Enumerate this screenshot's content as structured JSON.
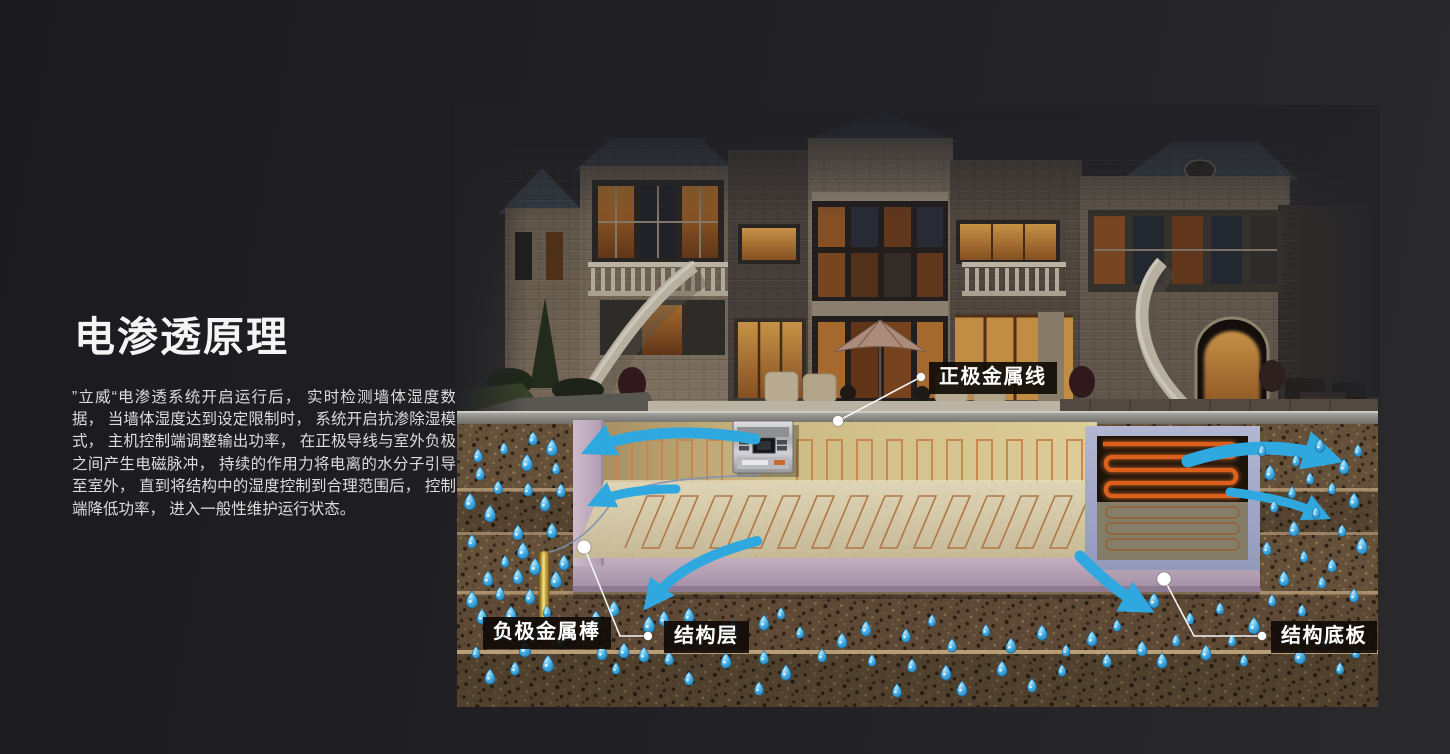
{
  "intro": {
    "title": "电渗透原理",
    "body": "”立威“电渗透系统开启运行后， 实时检测墙体湿度数据， 当墙体湿度达到设定限制时， 系统开启抗渗除湿模式， 主机控制端调整输出功率， 在正极导线与室外负极之间产生电磁脉冲， 持续的作用力将电离的水分子引导至室外， 直到将结构中的湿度控制到合理范围后， 控制端降低功率， 进入一般性维护运行状态。"
  },
  "diagram": {
    "labels": {
      "positive_wire": "正极金属线",
      "negative_rod": "负极金属棒",
      "structure_layer": "结构层",
      "base_plate": "结构底板"
    },
    "colors": {
      "arrow_blue": "#2fa8e0",
      "water_drop": "#4ab4e8",
      "copper_coil": "#c9854e",
      "structure_pink": "#c3b0c1",
      "right_frame_periwinkle": "#a8aecb",
      "soil_brown": "#65503a",
      "rod_gold": "#d8bc50",
      "label_background": "#14100a",
      "glow_coil_orange": "#dd5f1c"
    },
    "drops": [
      [
        533,
        438
      ],
      [
        552,
        447
      ],
      [
        504,
        448
      ],
      [
        478,
        455
      ],
      [
        527,
        462
      ],
      [
        556,
        468
      ],
      [
        480,
        473
      ],
      [
        498,
        487
      ],
      [
        528,
        489
      ],
      [
        561,
        490
      ],
      [
        470,
        501
      ],
      [
        545,
        503
      ],
      [
        490,
        513
      ],
      [
        518,
        532
      ],
      [
        552,
        530
      ],
      [
        472,
        541
      ],
      [
        523,
        550
      ],
      [
        505,
        561
      ],
      [
        535,
        566
      ],
      [
        564,
        562
      ],
      [
        488,
        578
      ],
      [
        518,
        576
      ],
      [
        556,
        579
      ],
      [
        500,
        593
      ],
      [
        472,
        599
      ],
      [
        530,
        596
      ],
      [
        547,
        611
      ],
      [
        511,
        614
      ],
      [
        482,
        616
      ],
      [
        540,
        630
      ],
      [
        500,
        634
      ],
      [
        525,
        648
      ],
      [
        560,
        640
      ],
      [
        476,
        652
      ],
      [
        548,
        663
      ],
      [
        515,
        668
      ],
      [
        490,
        676
      ],
      [
        596,
        618
      ],
      [
        614,
        608
      ],
      [
        649,
        624
      ],
      [
        664,
        618
      ],
      [
        689,
        615
      ],
      [
        764,
        622
      ],
      [
        781,
        613
      ],
      [
        602,
        652
      ],
      [
        624,
        650
      ],
      [
        644,
        654
      ],
      [
        669,
        658
      ],
      [
        689,
        678
      ],
      [
        726,
        660
      ],
      [
        764,
        657
      ],
      [
        786,
        672
      ],
      [
        616,
        668
      ],
      [
        842,
        640
      ],
      [
        866,
        628
      ],
      [
        906,
        635
      ],
      [
        932,
        620
      ],
      [
        952,
        645
      ],
      [
        986,
        630
      ],
      [
        1011,
        645
      ],
      [
        1042,
        632
      ],
      [
        1066,
        650
      ],
      [
        1092,
        638
      ],
      [
        1117,
        625
      ],
      [
        1142,
        648
      ],
      [
        872,
        660
      ],
      [
        912,
        665
      ],
      [
        946,
        672
      ],
      [
        1002,
        668
      ],
      [
        1062,
        670
      ],
      [
        1107,
        660
      ],
      [
        822,
        655
      ],
      [
        897,
        690
      ],
      [
        962,
        688
      ],
      [
        1032,
        685
      ],
      [
        759,
        688
      ],
      [
        700,
        640
      ],
      [
        733,
        628
      ],
      [
        800,
        632
      ],
      [
        1262,
        450
      ],
      [
        1296,
        460
      ],
      [
        1320,
        445
      ],
      [
        1344,
        466
      ],
      [
        1358,
        450
      ],
      [
        1270,
        472
      ],
      [
        1310,
        478
      ],
      [
        1292,
        492
      ],
      [
        1332,
        488
      ],
      [
        1354,
        500
      ],
      [
        1274,
        506
      ],
      [
        1316,
        512
      ],
      [
        1294,
        528
      ],
      [
        1342,
        530
      ],
      [
        1362,
        545
      ],
      [
        1267,
        548
      ],
      [
        1304,
        556
      ],
      [
        1332,
        565
      ],
      [
        1284,
        578
      ],
      [
        1322,
        582
      ],
      [
        1354,
        595
      ],
      [
        1272,
        600
      ],
      [
        1302,
        610
      ],
      [
        1154,
        600
      ],
      [
        1190,
        618
      ],
      [
        1220,
        608
      ],
      [
        1176,
        640
      ],
      [
        1206,
        652
      ],
      [
        1232,
        640
      ],
      [
        1162,
        660
      ],
      [
        1244,
        660
      ],
      [
        1254,
        625
      ],
      [
        1288,
        628
      ],
      [
        1326,
        640
      ],
      [
        1356,
        652
      ],
      [
        1300,
        655
      ],
      [
        1340,
        668
      ]
    ]
  }
}
